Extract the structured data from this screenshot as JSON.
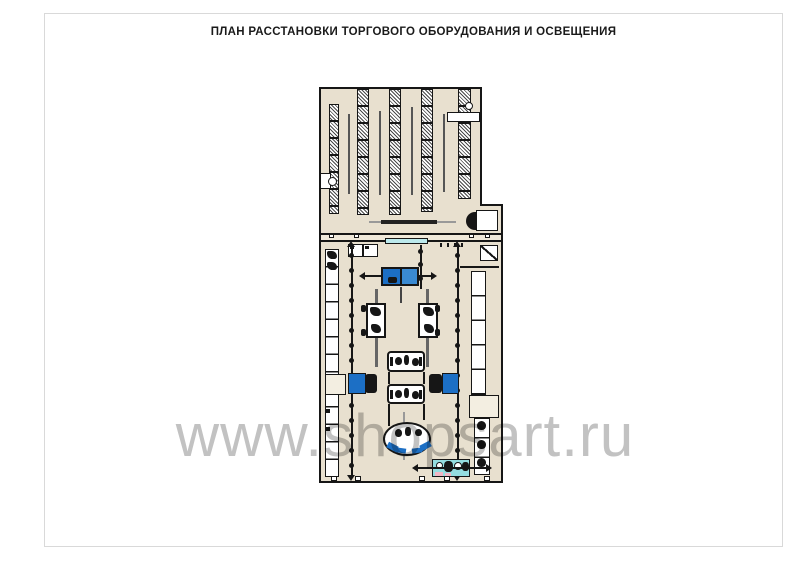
{
  "title": "ПЛАН РАССТАНОВКИ ТОРГОВОГО ОБОРУДОВАНИЯ И ОСВЕЩЕНИЯ",
  "watermark": "www.shopsart.ru",
  "colors": {
    "floor": "#e8e0cf",
    "wall": "#161616",
    "blue": "#1c6fc5",
    "cyan": "#94dde0",
    "pink": "#f0b6c4",
    "watermark_gray": "#8f8f8f",
    "page_border": "#d9d9d9"
  }
}
